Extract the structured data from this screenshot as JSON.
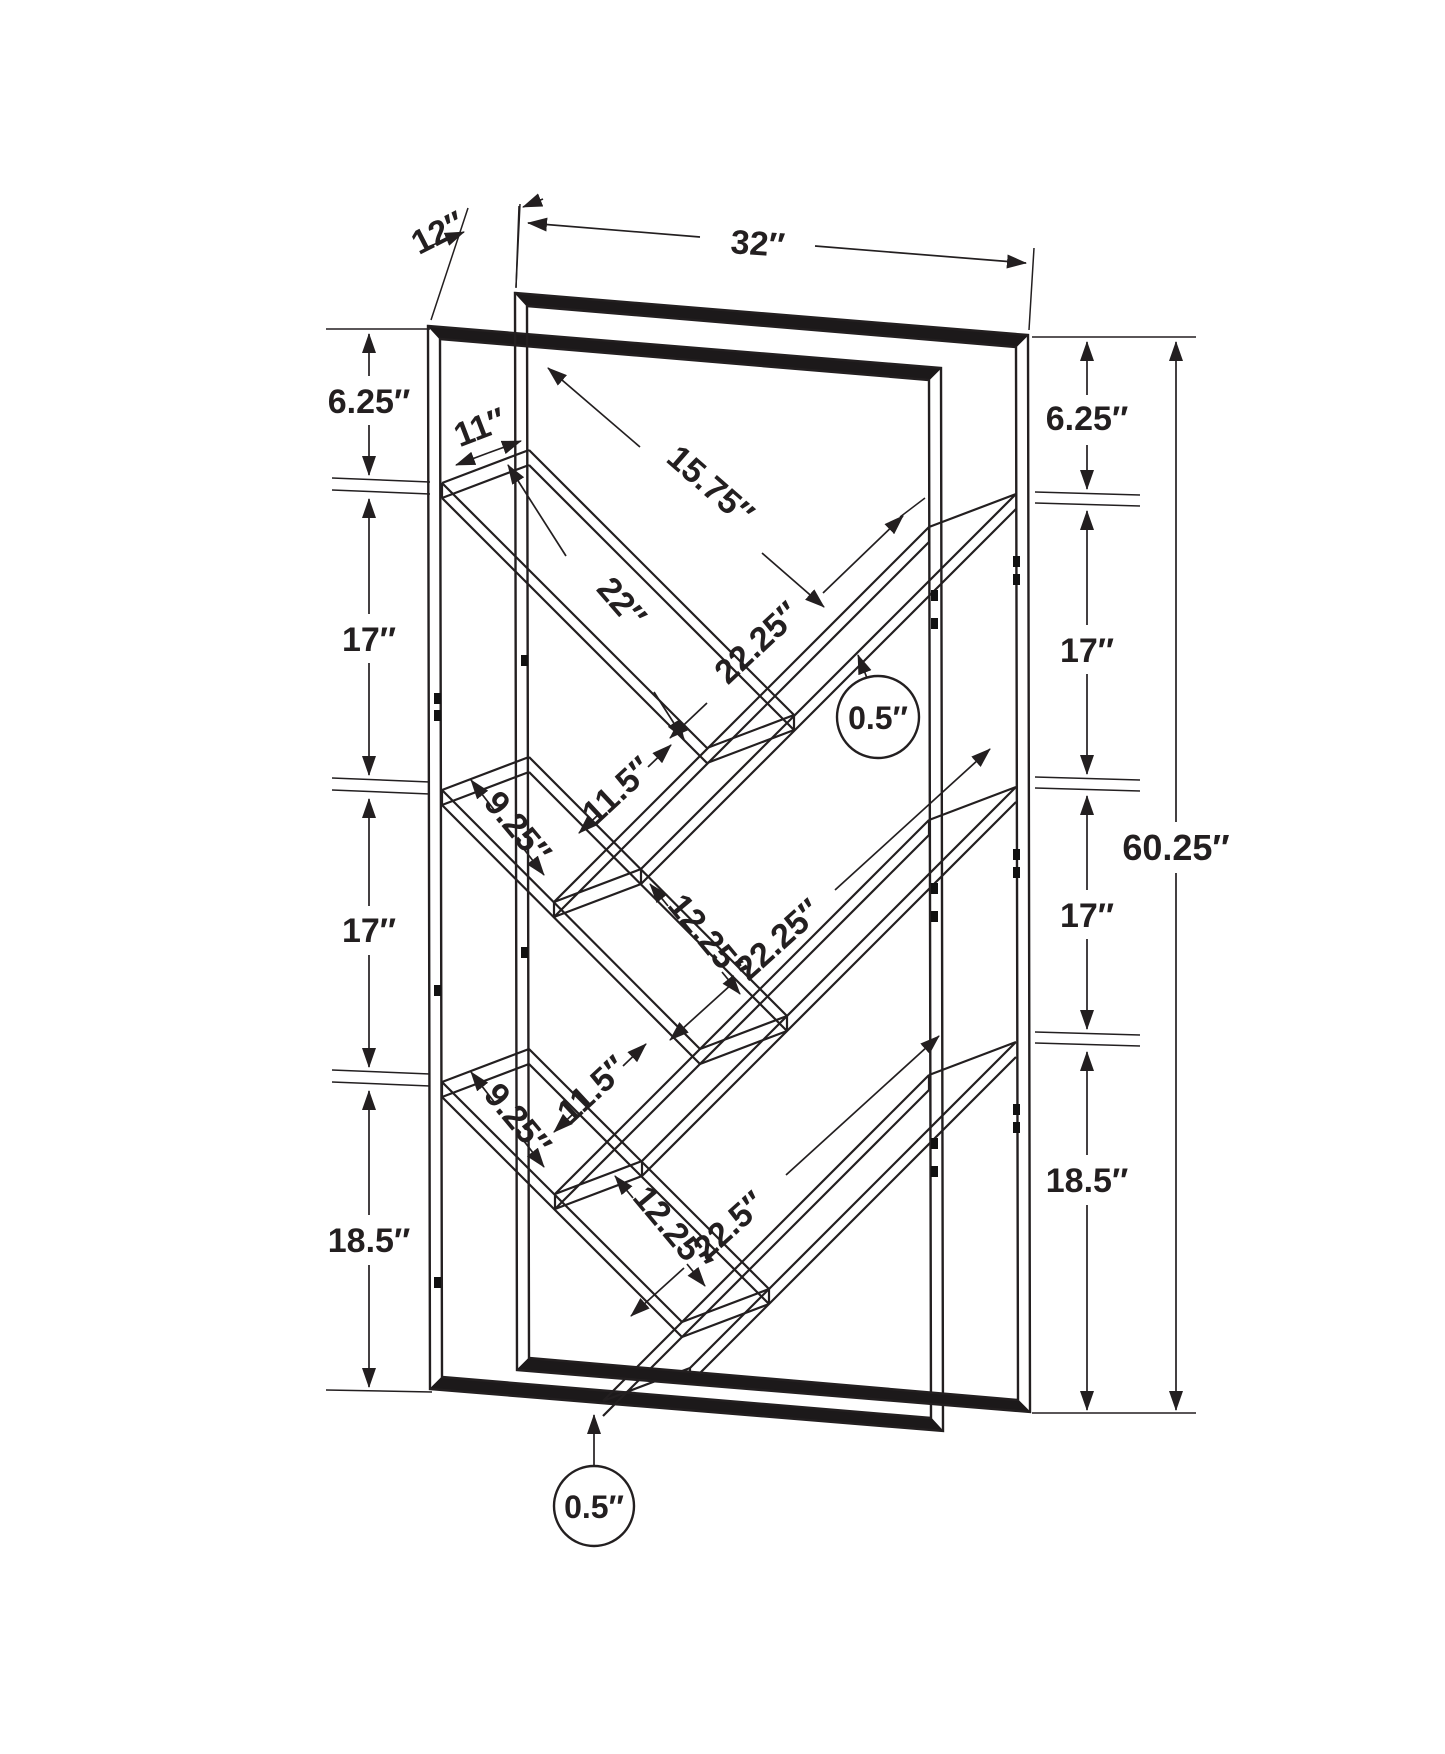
{
  "diagram": {
    "type": "furniture-dimension-drawing",
    "product": "v-shelf-bookcase-wireframe",
    "background_color": "#ffffff",
    "line_color": "#231f20",
    "dims": {
      "depth": "12″",
      "width": "32″",
      "height": "60.25″",
      "left": [
        "6.25″",
        "17″",
        "17″",
        "18.5″"
      ],
      "right": [
        "6.25″",
        "17″",
        "17″",
        "18.5″"
      ],
      "top_shelf": {
        "board_width": "11″",
        "board_length": "22″",
        "clearance": "15.75″",
        "right_board_length": "22.25″",
        "overhang": "11.5″",
        "tube_thickness": "0.5″"
      },
      "mid_shelf": {
        "board_width": "9.25″",
        "clearance": "12.25″",
        "right_board_length": "22.25″",
        "overhang": "11.5″"
      },
      "bottom_shelf": {
        "board_width": "9.25″",
        "clearance": "12.25″",
        "right_board_length": "22.5″",
        "tube_thickness": "0.5″"
      }
    }
  }
}
